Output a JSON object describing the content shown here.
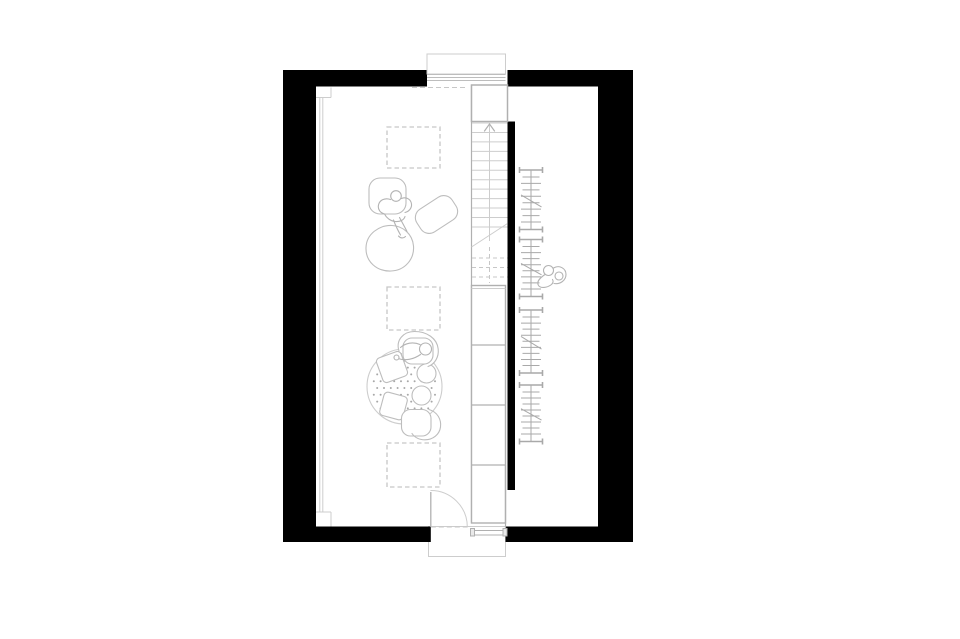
{
  "meta": {
    "description": "attic floor plan line drawing"
  },
  "canvas": {
    "w": 960,
    "h": 639,
    "bg": "#ffffff"
  },
  "palette": {
    "wall": "#000000",
    "line": "#bdbdbd",
    "line_mid": "#b0b0b0",
    "line_light": "#cdcdcd",
    "dash": "#c7c7c7",
    "dot": "#a8a8a8",
    "rail": "#a9a9a9",
    "person": "#b3b3b3",
    "white": "#ffffff"
  },
  "plan": {
    "walls": [
      {
        "name": "top-wall-left",
        "x": 283,
        "y": 70,
        "w": 144,
        "h": 16.5
      },
      {
        "name": "top-wall-right",
        "x": 507.5,
        "y": 70,
        "w": 125.5,
        "h": 16.5
      },
      {
        "name": "left-wall",
        "x": 283,
        "y": 70,
        "w": 33,
        "h": 472
      },
      {
        "name": "right-wall",
        "x": 598,
        "y": 70,
        "w": 35,
        "h": 472
      },
      {
        "name": "bottom-wall-left",
        "x": 283,
        "y": 526.5,
        "w": 147.8,
        "h": 15.5
      },
      {
        "name": "bottom-wall-right",
        "x": 505.5,
        "y": 526.5,
        "w": 127.5,
        "h": 15.5
      },
      {
        "name": "stair-side-wall",
        "x": 507.5,
        "y": 121.5,
        "w": 7.5,
        "h": 368.5
      }
    ],
    "dormer": {
      "box": [
        427,
        54,
        78.5,
        20
      ],
      "glazing_y": [
        74.5,
        77.5,
        80.5
      ],
      "glazing_x1": 427,
      "glazing_x2": 505.5,
      "dash_line": [
        412,
        87.5,
        468,
        87.5
      ]
    },
    "window_left": {
      "lines": [
        [
          319.8,
          97.5,
          319.8,
          512
        ],
        [
          322.8,
          97.5,
          322.8,
          512
        ],
        [
          316,
          97.5,
          331,
          97.5
        ],
        [
          331,
          87.5,
          331,
          97.5
        ],
        [
          316,
          512,
          331,
          512
        ],
        [
          331,
          512,
          331,
          526.5
        ]
      ]
    },
    "skylights": [
      {
        "name": "skylight-top",
        "r": [
          387,
          127,
          53,
          41
        ]
      },
      {
        "name": "skylight-middle",
        "r": [
          387,
          287,
          53,
          43
        ]
      },
      {
        "name": "skylight-bottom",
        "r": [
          387,
          443,
          53,
          44
        ]
      }
    ],
    "stair": {
      "shaft_left": [
        471.5,
        85,
        471.5,
        523
      ],
      "landing": [
        471.5,
        85,
        36,
        36.5
      ],
      "tread_x1": 472,
      "tread_x2": 507.5,
      "tread_y0": 123,
      "tread_step": 9.45,
      "tread_count": 12,
      "break_line": [
        471.5,
        247,
        507.5,
        223.5
      ],
      "dashed_treads": [
        258,
        267.5,
        277
      ],
      "center_x": 489.5,
      "arrow_tip_y": 124,
      "arrow_half": 5,
      "arrow_drop": 7,
      "center_solid_to": 241,
      "center_dash": [
        247,
        283
      ],
      "boxes": {
        "rect": [
          471.5,
          285.5,
          34,
          237.5
        ],
        "double_top": 288.5,
        "dividers": [
          345,
          405,
          465
        ]
      },
      "vestibule_line": [
        505.5,
        465,
        505.5,
        530
      ],
      "threshold": {
        "x1": 471,
        "x2": 507,
        "y1": 530.5,
        "y2": 535,
        "blocks": [
          [
            470.5,
            528.5,
            4,
            7.5
          ],
          [
            503,
            528.5,
            4,
            7.5
          ]
        ]
      }
    },
    "door": {
      "leaf": [
        430.8,
        492,
        430.8,
        527
      ],
      "arc": "M 430.8 490.5 A 36.5 36.5 0 0 1 467.3 527",
      "dash": [
        430.8,
        527,
        467.3,
        527
      ]
    },
    "stoop": [
      428.5,
      526.5,
      77,
      30
    ],
    "furniture": {
      "armchair": [
        369,
        178,
        37,
        36,
        11
      ],
      "ottoman": {
        "cx": 436.5,
        "cy": 214.5,
        "w": 42,
        "h": 27,
        "rx": 10,
        "rot": -33
      },
      "beanbag_path": "M 392 225.5 C 403 226 412.5 234 413.5 246 C 414.5 259 405 270.5 391 271 C 377 271.5 365.5 262 366 247.5 C 366.5 234 379 225 392 225.5 Z"
    },
    "rug": {
      "cx": 404.5,
      "cy": 386.5,
      "r": 37.5,
      "dot_step": 6.8,
      "dot_r": 1,
      "cushions": [
        {
          "cx": 392,
          "cy": 367,
          "s": 26,
          "rot": -20
        },
        {
          "cx": 393.5,
          "cy": 406,
          "s": 24,
          "rot": 15
        }
      ],
      "stools": [
        [
          426.5,
          373.5,
          9.5
        ],
        [
          421.5,
          395.5,
          9.5
        ]
      ],
      "chair_top": {
        "back": "M 399 351 C 395.5 340 403.5 331.5 414.5 331.5 C 426.5 331.5 437 338 438.2 349 C 439 357 435 364 428 366.5",
        "seat": [
          403,
          338,
          30,
          26,
          9
        ]
      },
      "chair_bottom": {
        "seat": [
          401.5,
          409.5,
          29.5,
          26.5,
          9
        ],
        "back": "M 429 409.5 C 437.5 412 441.5 419.5 440.5 427 C 439.5 434.5 433 439.8 425 439.8 C 419 439.8 414.5 437.2 412 433.5"
      }
    },
    "rails": {
      "x1": 519.5,
      "x2": 542.5,
      "center_x": 531,
      "items": [
        {
          "name": "wardrobe-rail-1",
          "top": 170,
          "bottom": 229.5,
          "rungs": 8
        },
        {
          "name": "wardrobe-rail-2",
          "top": 239.5,
          "bottom": 296.5,
          "rungs": 8
        },
        {
          "name": "wardrobe-rail-3",
          "top": 310,
          "bottom": 373,
          "rungs": 9
        },
        {
          "name": "wardrobe-rail-4",
          "top": 385,
          "bottom": 441.5,
          "rungs": 8
        }
      ]
    },
    "persons": [
      {
        "name": "person-at-armchair",
        "head": [
          396,
          196,
          5.3
        ],
        "paths": [
          "M 390.5 199.5 C 385 197.5 379.5 200 378.5 205 C 377.5 209.5 380.5 213 384.5 214",
          "M 401.5 198.5 C 406.5 196.5 411 199.5 411.5 204 C 412 208 409 211.5 405 212.5",
          "M 384.5 214 C 386.5 218 390.5 221 395 221.5 C 400 222 404 220 405 216.5",
          "M 393.5 220 C 395.5 225.5 398 230.5 400.5 235",
          "M 399.5 217.5 C 402.5 223 405 227.5 407 231.5",
          "M 398.5 236 C 400.5 238.5 403.5 238.5 405.5 236.5"
        ]
      },
      {
        "name": "person-on-rug",
        "head": [
          425.5,
          349,
          6
        ],
        "paths": [
          "M 420 344.5 C 413 341.5 405.5 343 400.5 347.5",
          "M 420.5 354.5 C 413.5 359.5 405 361 398 358.5",
          "M 422 346 C 424 343.5 428 343.5 430 346"
        ],
        "extra_circle": [
          396.5,
          357.5,
          2.5
        ]
      },
      {
        "name": "person-right-room",
        "head": [
          548.5,
          270.5,
          5
        ],
        "paths": [
          "M 553.5 268 C 559.5 264.5 566 268.5 566 274.5 C 566 280.5 560 284.5 554 283.5",
          "M 545 274.5 C 539 278.5 536.5 282.5 538.5 285.5 C 540.5 288.5 547 288 551.5 284.5 C 553 283 553.5 281 552.5 279.5"
        ],
        "extra_circle": [
          559,
          276,
          4
        ]
      }
    ]
  }
}
